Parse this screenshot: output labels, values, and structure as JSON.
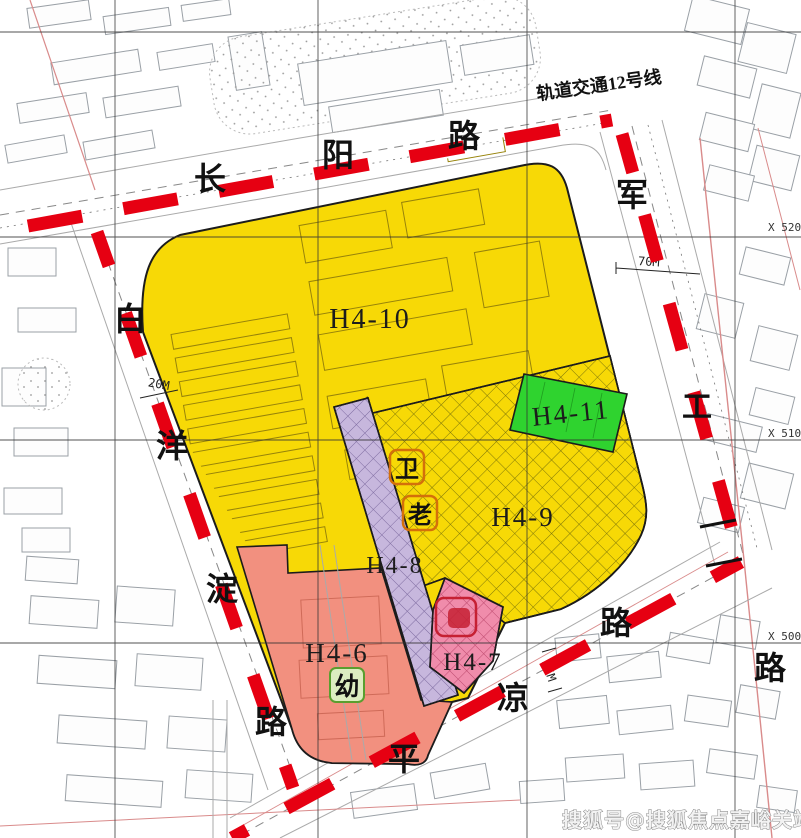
{
  "annotations": {
    "rail_line": "轨道交通12号线",
    "dim_west": "20M",
    "dim_east": "70M",
    "dim_south": "35M"
  },
  "grid_labels": {
    "x5200": "X 5200",
    "x5100": "X 5100",
    "x5000": "X 5000"
  },
  "roads": {
    "changyang": [
      "长",
      "阳",
      "路"
    ],
    "jungong": [
      "军",
      "工",
      "路"
    ],
    "baiyangdian": [
      "白",
      "洋",
      "淀",
      "路"
    ],
    "pingliang": [
      "平",
      "凉",
      "路"
    ]
  },
  "parcels": {
    "h4_10": {
      "label": "H4-10",
      "color": "#f7d906"
    },
    "h4_11": {
      "label": "H4-11",
      "color": "#2fd32f"
    },
    "h4_9": {
      "label": "H4-9",
      "color": "#f7d906"
    },
    "h4_8": {
      "label": "H4-8",
      "color": "#c7b7dd"
    },
    "h4_7": {
      "label": "H4-7",
      "color": "#f08cab"
    },
    "h4_6": {
      "label": "H4-6",
      "color": "#f2907f"
    }
  },
  "symbols": {
    "kindergarten": "幼",
    "health": "卫",
    "elderly": "老"
  },
  "watermark": "搜狐号@搜狐焦点嘉峪关站",
  "colors": {
    "boundary_red": "#e60012",
    "grid_black": "#333333",
    "road_pink_line": "#d98b8b",
    "hatch_olive": "#55550a"
  }
}
